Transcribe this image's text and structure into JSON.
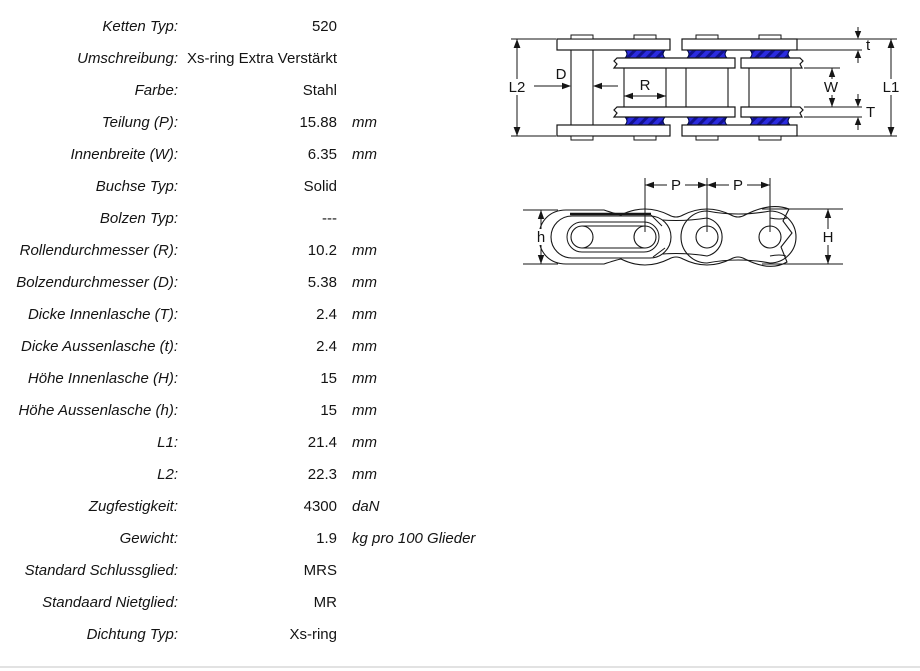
{
  "table": {
    "rows": [
      {
        "label": "Ketten Typ:",
        "value": "520",
        "unit": ""
      },
      {
        "label": "Umschreibung:",
        "value": "Xs-ring Extra Verstärkt",
        "unit": ""
      },
      {
        "label": "Farbe:",
        "value": "Stahl",
        "unit": ""
      },
      {
        "label": "Teilung (P):",
        "value": "15.88",
        "unit": "mm"
      },
      {
        "label": "Innenbreite (W):",
        "value": "6.35",
        "unit": "mm"
      },
      {
        "label": "Buchse Typ:",
        "value": "Solid",
        "unit": ""
      },
      {
        "label": "Bolzen Typ:",
        "value": "---",
        "unit": ""
      },
      {
        "label": "Rollendurchmesser (R):",
        "value": "10.2",
        "unit": "mm"
      },
      {
        "label": "Bolzendurchmesser (D):",
        "value": "5.38",
        "unit": "mm"
      },
      {
        "label": "Dicke Innenlasche (T):",
        "value": "2.4",
        "unit": "mm"
      },
      {
        "label": "Dicke Aussenlasche (t):",
        "value": "2.4",
        "unit": "mm"
      },
      {
        "label": "Höhe Innenlasche (H):",
        "value": "15",
        "unit": "mm"
      },
      {
        "label": "Höhe Aussenlasche (h):",
        "value": "15",
        "unit": "mm"
      },
      {
        "label": "L1:",
        "value": "21.4",
        "unit": "mm"
      },
      {
        "label": "L2:",
        "value": "22.3",
        "unit": "mm"
      },
      {
        "label": "Zugfestigkeit:",
        "value": "4300",
        "unit": "daN"
      },
      {
        "label": "Gewicht:",
        "value": "1.9",
        "unit": "kg pro 100 Glieder"
      },
      {
        "label": "Standard Schlussglied:",
        "value": "MRS",
        "unit": ""
      },
      {
        "label": "Standaard Nietglied:",
        "value": "MR",
        "unit": ""
      },
      {
        "label": "Dichtung Typ:",
        "value": "Xs-ring",
        "unit": ""
      }
    ]
  },
  "diagram_top_view": {
    "labels": {
      "L2": "L2",
      "D": "D",
      "R": "R",
      "t": "t",
      "W": "W",
      "T": "T",
      "L1": "L1"
    },
    "seal_color": "#2b2bdf",
    "seal_hatch_color": "#12128e",
    "line_color": "#161616"
  },
  "diagram_side_view": {
    "labels": {
      "P1": "P",
      "P2": "P",
      "h": "h",
      "H": "H"
    }
  }
}
